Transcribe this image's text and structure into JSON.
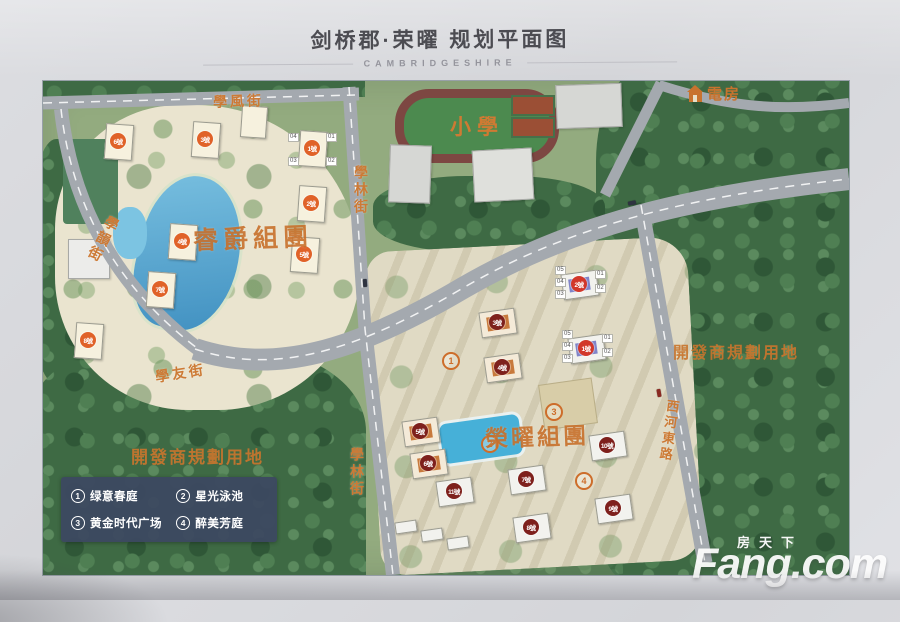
{
  "header": {
    "title": "剑桥郡·荣曜 规划平面图",
    "subtitle": "CAMBRIDGESHIRE"
  },
  "map": {
    "streets": {
      "xuefeng": "學風街",
      "xuelin": "學林街",
      "xueyun": "學韻街",
      "xueyou": "學友街",
      "xihe_east": "西河東路"
    },
    "areas": {
      "school": "小學",
      "power_house": "電房",
      "cluster_left": "睿爵組團",
      "cluster_right": "榮曜組團",
      "dev_land": "開發商規劃用地"
    },
    "buildings": {
      "left": [
        "1號",
        "2號",
        "3號",
        "4號",
        "5號",
        "6號",
        "7號",
        "8號"
      ],
      "right": [
        "1號",
        "2號",
        "3號",
        "4號",
        "5號",
        "6號",
        "7號",
        "8號",
        "9號",
        "10號",
        "11號"
      ]
    },
    "unit_labels": [
      "01",
      "02",
      "03",
      "04",
      "05"
    ],
    "markers": [
      "1",
      "2",
      "3",
      "4"
    ],
    "legend": {
      "items": [
        {
          "num": "1",
          "label": "绿意春庭"
        },
        {
          "num": "2",
          "label": "星光泳池"
        },
        {
          "num": "3",
          "label": "黄金时代广场"
        },
        {
          "num": "4",
          "label": "醉美芳庭"
        }
      ]
    }
  },
  "watermark": {
    "cn": "房天下",
    "en": "Fang.com"
  },
  "colors": {
    "accent_orange": "#c8752e",
    "badge_orange": "#e06228",
    "badge_red": "#d2372a",
    "badge_dark": "#7e201c",
    "legend_bg": "#3d4861",
    "road_gray": "#a4a9af",
    "water_blue": "#4e9ac6"
  }
}
